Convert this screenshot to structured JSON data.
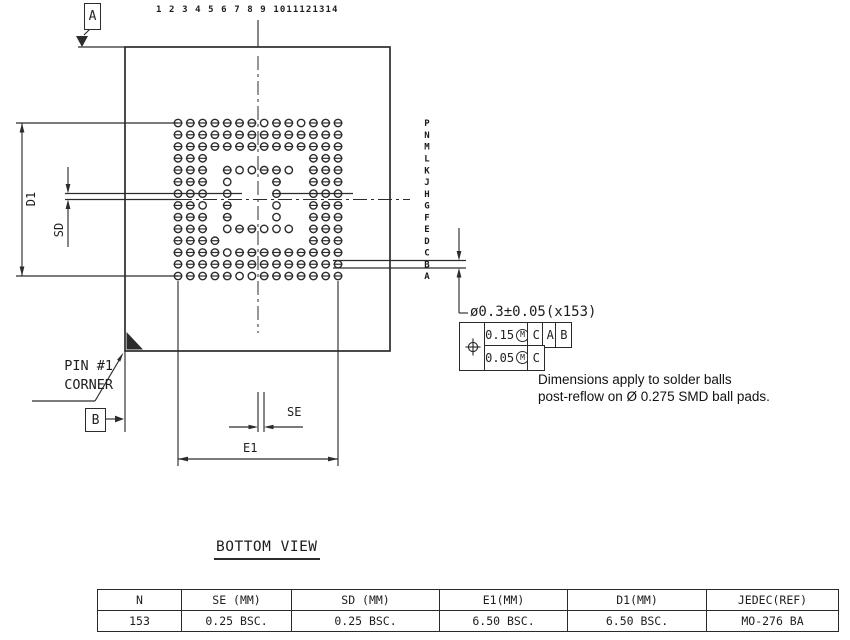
{
  "drawing": {
    "title": "BOTTOM VIEW",
    "datum_a": "A",
    "datum_b": "B",
    "pin1_line1": "PIN #1",
    "pin1_line2": "CORNER",
    "dim_d1": "D1",
    "dim_sd": "SD",
    "dim_se": "SE",
    "dim_e1": "E1",
    "column_numbers_text": "1 2 3 4 5 6 7 8 9 1011121314",
    "row_labels": [
      "P",
      "N",
      "M",
      "L",
      "K",
      "J",
      "H",
      "G",
      "F",
      "E",
      "D",
      "C",
      "B",
      "A"
    ],
    "ball_map": [
      "BBBBBBBOBBOBBB",
      "BBBBBBBBBBBBBB",
      "BBBBBBBBBBBBBB",
      "BBB........BBB",
      "BBB.BOOBBO.BBB",
      "BBB.O...B..BBB",
      "BBB.O...B..BBB",
      "BBO.B...O..BBB",
      "BBB.B...O..BBB",
      "BBB.OBBOOO.BBB",
      "BBBB.......BBB",
      "BBBBOBBBBBBBBB",
      "BBBBBBBBBBBBBB",
      "BBBBBOOBBBBBBB"
    ],
    "ball_count_note": "153",
    "ball_callout": "ø0.3±0.05(x153)",
    "tolerance_frame": {
      "row1": {
        "symbol": "position",
        "tolerance": "0.15",
        "modifier": "M",
        "datum_refs": [
          "C",
          "A",
          "B"
        ]
      },
      "row2": {
        "tolerance": "0.05",
        "modifier": "M",
        "datum_refs": [
          "C"
        ]
      }
    },
    "note_line1": "Dimensions apply to solder balls",
    "note_line2": "post-reflow on Ø 0.275 SMD ball pads."
  },
  "table": {
    "headers": [
      "N",
      "SE (MM)",
      "SD (MM)",
      "E1(MM)",
      "D1(MM)",
      "JEDEC(REF)"
    ],
    "values": [
      "153",
      "0.25 BSC.",
      "0.25 BSC.",
      "6.50 BSC.",
      "6.50 BSC.",
      "MO-276 BA"
    ]
  }
}
